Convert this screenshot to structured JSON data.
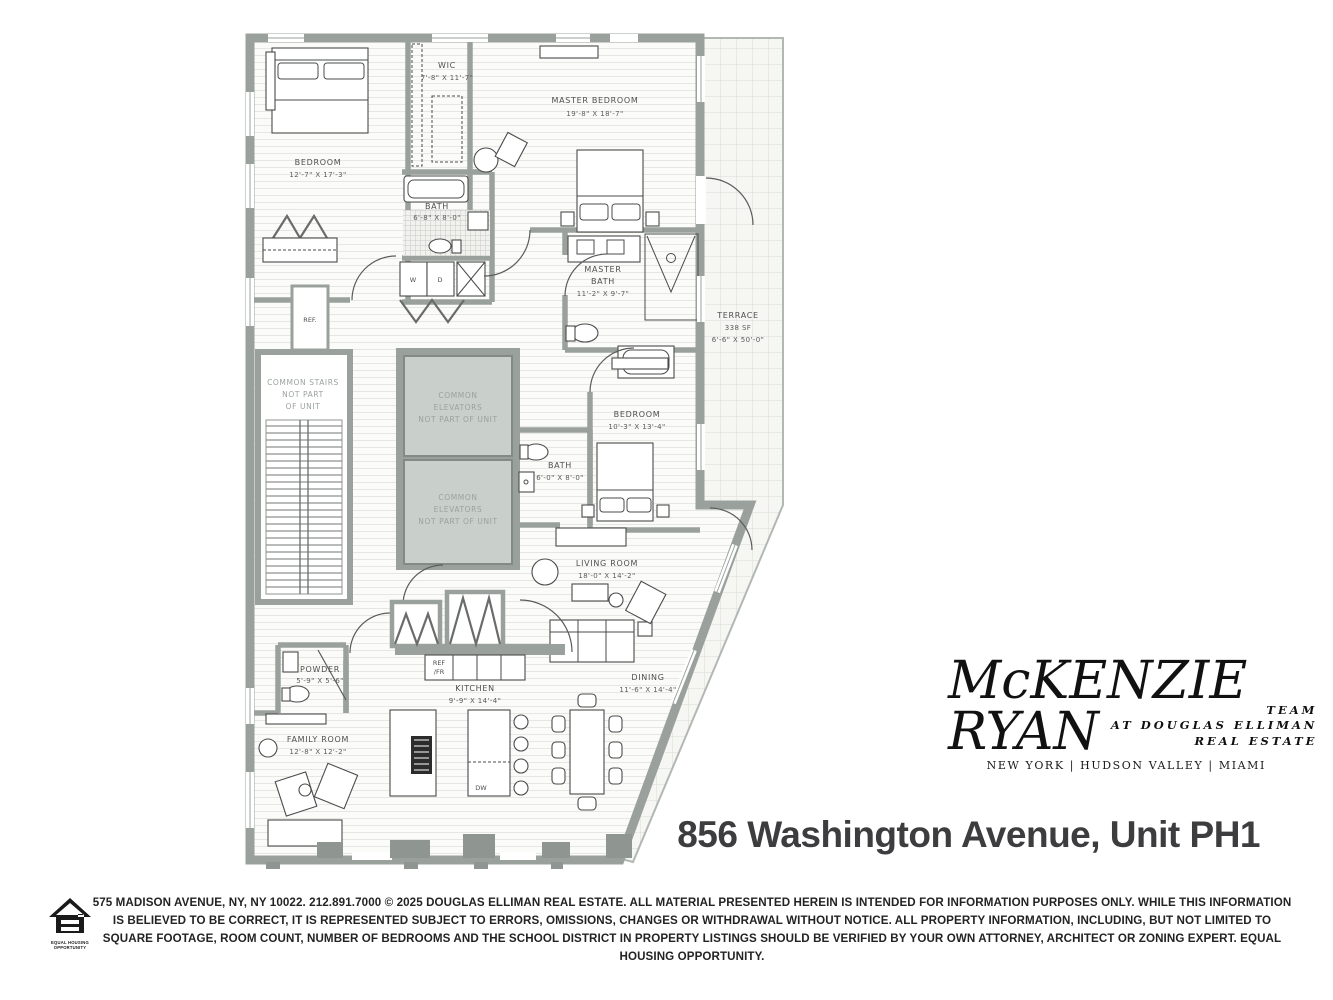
{
  "title": "856 Washington Avenue, Unit PH1",
  "logo": {
    "name_line1": "McKENZIE",
    "name_line2": "RYAN",
    "team_line1": "TEAM",
    "team_line2": "AT DOUGLAS ELLIMAN",
    "team_line3": "REAL ESTATE",
    "locations": "NEW YORK  |  HUDSON VALLEY  |  MIAMI"
  },
  "floorplan": {
    "rooms": {
      "bedroom_upper": {
        "name": "BEDROOM",
        "dims": "12'-7\" X 17'-3\""
      },
      "wic": {
        "name": "WIC",
        "dims": "7'-8\" X 11'-7\""
      },
      "master_bedroom": {
        "name": "MASTER BEDROOM",
        "dims": "19'-8\" X 18'-7\""
      },
      "bath_upper": {
        "name": "BATH",
        "dims": "6'-8\" X 8'-0\""
      },
      "master_bath": {
        "line1": "MASTER",
        "line2": "BATH",
        "dims": "11'-2\" X 9'-7\""
      },
      "terrace": {
        "name": "TERRACE",
        "area": "338 SF",
        "dims": "6'-6\" X 50'-0\""
      },
      "common_stairs": {
        "line1": "COMMON STAIRS",
        "line2": "NOT PART",
        "line3": "OF UNIT"
      },
      "elevators": {
        "line1": "COMMON",
        "line2": "ELEVATORS",
        "line3": "NOT PART OF UNIT"
      },
      "bedroom_middle": {
        "name": "BEDROOM",
        "dims": "10'-3\" X 13'-4\""
      },
      "bath_middle": {
        "name": "BATH",
        "dims": "6'-0\" X 8'-0\""
      },
      "living_room": {
        "name": "LIVING ROOM",
        "dims": "18'-0\" X 14'-2\""
      },
      "powder": {
        "name": "POWDER",
        "dims": "5'-9\" X 5'-6\""
      },
      "kitchen": {
        "name": "KITCHEN",
        "dims": "9'-9\" X 14'-4\""
      },
      "dining": {
        "name": "DINING",
        "dims": "11'-6\" X 14'-4\""
      },
      "family_room": {
        "name": "FAMILY ROOM",
        "dims": "12'-8\" X 12'-2\""
      }
    },
    "fixtures": {
      "ref_closet": "REF.",
      "ref_fr_line1": "REF",
      "ref_fr_line2": "/FR",
      "washer": "W",
      "dryer": "D",
      "dishwasher": "DW"
    }
  },
  "footer": {
    "disclaimer": "575 MADISON AVENUE, NY, NY 10022. 212.891.7000 © 2025 DOUGLAS ELLIMAN REAL ESTATE. ALL MATERIAL PRESENTED HEREIN IS INTENDED FOR INFORMATION PURPOSES ONLY. WHILE THIS INFORMATION IS BELIEVED TO BE CORRECT, IT IS REPRESENTED SUBJECT TO ERRORS, OMISSIONS, CHANGES OR WITHDRAWAL WITHOUT NOTICE. ALL PROPERTY INFORMATION, INCLUDING, BUT NOT LIMITED TO SQUARE FOOTAGE, ROOM COUNT, NUMBER OF BEDROOMS AND THE SCHOOL DISTRICT IN PROPERTY LISTINGS SHOULD BE VERIFIED BY YOUR OWN ATTORNEY, ARCHITECT OR ZONING EXPERT. EQUAL HOUSING OPPORTUNITY.",
    "eho_caption_line1": "EQUAL HOUSING",
    "eho_caption_line2": "OPPORTUNITY"
  },
  "colors": {
    "wall_gray": "#9aa19d",
    "elevator_fill": "#c9cfcb",
    "floor_line": "#e6e6e2",
    "title_text": "#3d3d3f",
    "logo_text": "#111111"
  }
}
